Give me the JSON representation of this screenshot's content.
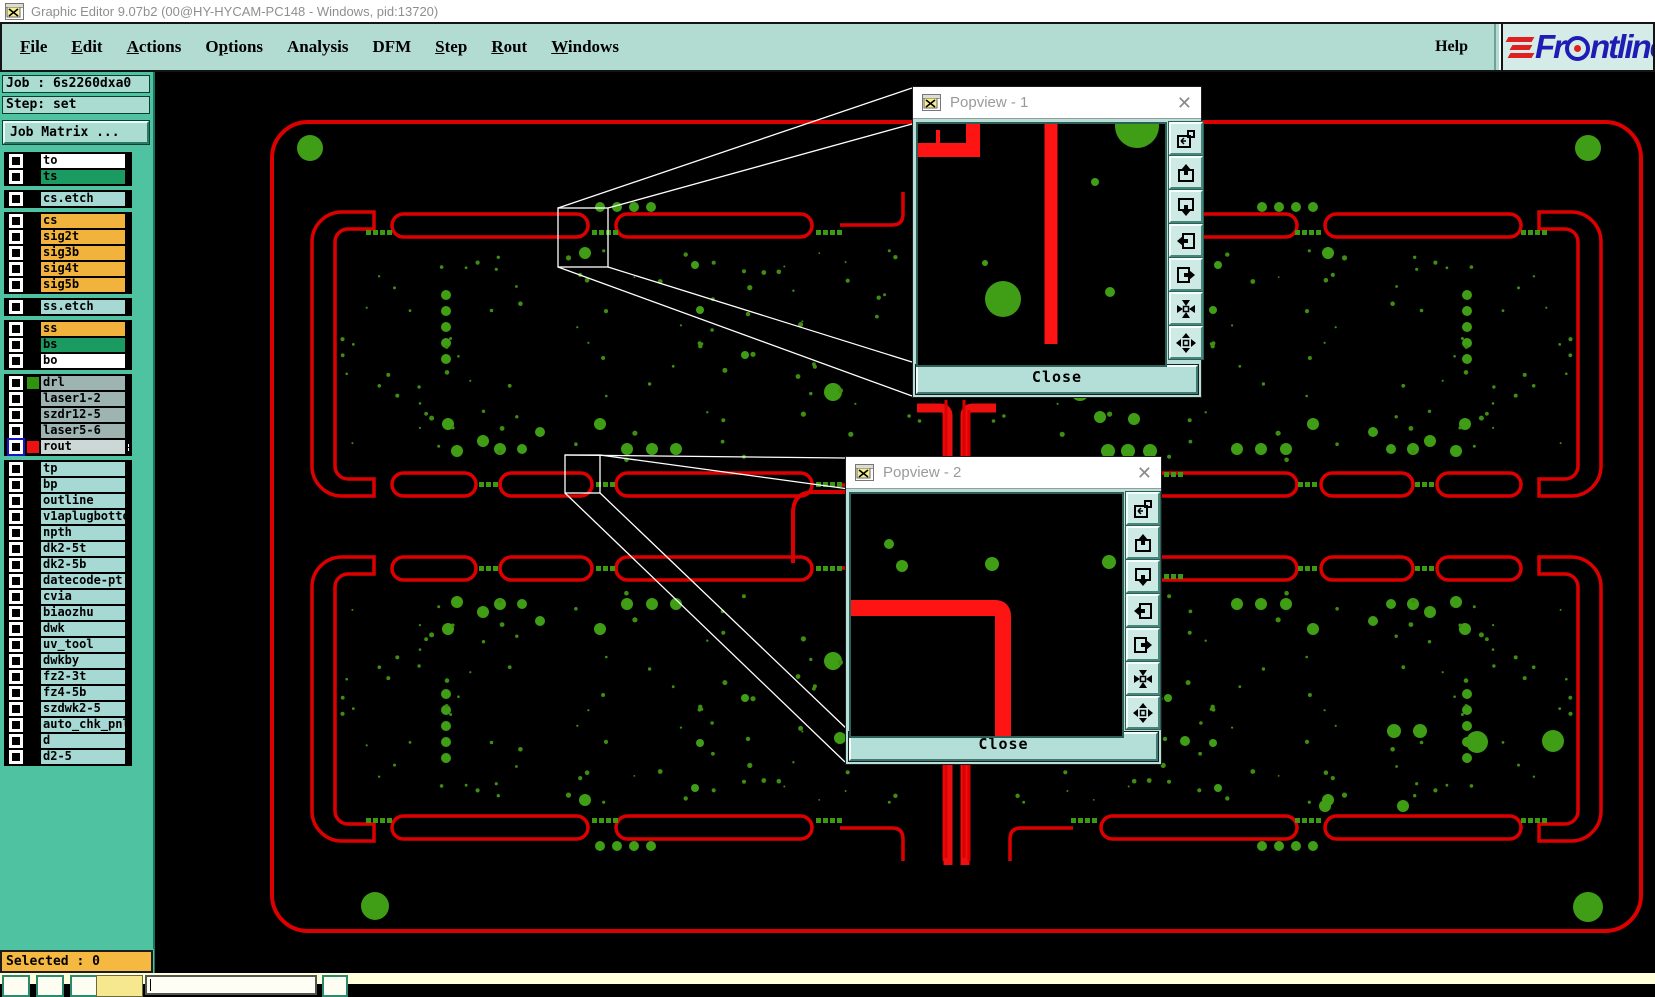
{
  "window": {
    "title": "Graphic Editor 9.07b2 (00@HY-HYCAM-PC148 - Windows, pid:13720)",
    "app_icon": "app-window-icon"
  },
  "menu_bar": {
    "items": [
      {
        "label": "File",
        "u": 0
      },
      {
        "label": "Edit",
        "u": 0
      },
      {
        "label": "Actions",
        "u": 0
      },
      {
        "label": "Options",
        "u": 1
      },
      {
        "label": "Analysis",
        "u": -1
      },
      {
        "label": "DFM",
        "u": -1
      },
      {
        "label": "Step",
        "u": 0
      },
      {
        "label": "Rout",
        "u": 0
      },
      {
        "label": "Windows",
        "u": 0
      }
    ],
    "help_label": "Help",
    "logo_text": "Frontline"
  },
  "sidebar": {
    "job_line": "Job : 6s2260dxa0",
    "step_line": "Step: set",
    "job_matrix_button": "Job Matrix ...",
    "selected_status": "Selected : 0",
    "layer_groups": [
      {
        "layers": [
          {
            "name": "to",
            "color": "white"
          },
          {
            "name": "ts",
            "color": "green"
          }
        ]
      },
      {
        "layers": [
          {
            "name": "cs.etch",
            "color": "cyan"
          }
        ]
      },
      {
        "layers": [
          {
            "name": "cs",
            "color": "orange"
          },
          {
            "name": "sig2t",
            "color": "orange"
          },
          {
            "name": "sig3b",
            "color": "orange"
          },
          {
            "name": "sig4t",
            "color": "orange"
          },
          {
            "name": "sig5b",
            "color": "orange"
          }
        ]
      },
      {
        "layers": [
          {
            "name": "ss.etch",
            "color": "cyan"
          }
        ]
      },
      {
        "layers": [
          {
            "name": "ss",
            "color": "orange"
          },
          {
            "name": "bs",
            "color": "green"
          },
          {
            "name": "bo",
            "color": "white"
          }
        ]
      },
      {
        "layers": [
          {
            "name": "drl",
            "color": "gray",
            "chip": "#2f9410"
          },
          {
            "name": "laser1-2",
            "color": "gray"
          },
          {
            "name": "szdr12-5",
            "color": "gray"
          },
          {
            "name": "laser5-6",
            "color": "gray"
          },
          {
            "name": "rout",
            "color": "lightgray",
            "chip": "#ee1111",
            "selected": true,
            "grid_icon": true
          }
        ]
      },
      {
        "layers": [
          {
            "name": "tp",
            "color": "cyan"
          },
          {
            "name": "bp",
            "color": "cyan"
          },
          {
            "name": "outline",
            "color": "cyan"
          },
          {
            "name": "v1aplugbotto",
            "color": "cyan"
          },
          {
            "name": "npth",
            "color": "cyan"
          },
          {
            "name": "dk2-5t",
            "color": "cyan"
          },
          {
            "name": "dk2-5b",
            "color": "cyan"
          },
          {
            "name": "datecode-pt",
            "color": "cyan"
          },
          {
            "name": "cvia",
            "color": "cyan"
          },
          {
            "name": "biaozhu",
            "color": "cyan"
          },
          {
            "name": "dwk",
            "color": "cyan"
          },
          {
            "name": "uv_tool",
            "color": "cyan"
          },
          {
            "name": "dwkby",
            "color": "cyan"
          },
          {
            "name": "fz2-3t",
            "color": "cyan"
          },
          {
            "name": "fz4-5b",
            "color": "cyan"
          },
          {
            "name": "szdwk2-5",
            "color": "cyan"
          },
          {
            "name": "auto_chk_pnl",
            "color": "cyan"
          },
          {
            "name": "d",
            "color": "cyan"
          },
          {
            "name": "d2-5",
            "color": "cyan"
          }
        ]
      }
    ]
  },
  "popviews": [
    {
      "title": "Popview - 1",
      "close_label": "Close"
    },
    {
      "title": "Popview - 2",
      "close_label": "Close"
    }
  ],
  "popview_toolbar_icons": [
    "detach-view-icon",
    "pan-up-icon",
    "pan-down-icon",
    "pan-left-icon",
    "pan-right-icon",
    "zoom-fit-icon",
    "move-center-icon"
  ],
  "colors": {
    "menu_bg": "#b2dcd2",
    "sidebar_bg": "#4fc3a1",
    "panel_light": "#aadcd2",
    "layer_orange": "#f2b33d",
    "layer_green": "#1b9a62",
    "layer_cyan": "#a6d9d4",
    "layer_gray": "#9db4b0",
    "layer_lightgray": "#ccd8d5",
    "trace_red": "#dd0000",
    "popview_red": "#ff1414",
    "drill_green": "#3f9e16",
    "status_orange": "#f5b942",
    "logo_blue": "#1d1db5",
    "logo_red": "#e02020",
    "bottom_strip": "#ffffd9"
  },
  "canvas": {
    "dot_seed": 20260117,
    "dot_region": {
      "x": 340,
      "y": 248,
      "w": 585,
      "h": 215,
      "count": 95
    }
  }
}
